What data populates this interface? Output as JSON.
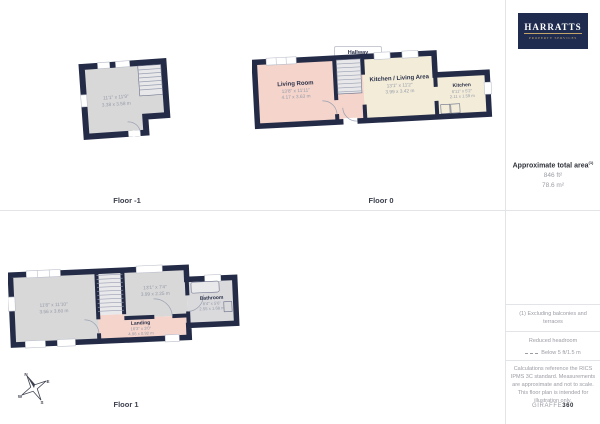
{
  "branding": {
    "logo_line1": "HARRATTS",
    "logo_line2": "PROPERTY SERVICES"
  },
  "sidebar": {
    "area_title": "Approximate total area",
    "area_superscript": "(1)",
    "area_ft": "846 ft²",
    "area_m": "78.6 m²",
    "note1": "(1) Excluding balconies and terraces",
    "headroom_title": "Reduced headroom",
    "headroom_value": "Below 5 ft/1.5 m",
    "disclaimer": "Calculations reference the RICS IPMS 3C standard. Measurements are approximate and not to scale. This floor plan is intended for illustration only.",
    "brand_gray": "GIRAFFE",
    "brand_bold": "360"
  },
  "floor_minus1": {
    "label": "Floor -1",
    "room": {
      "dims_ft": "11'1\" x 11'9\"",
      "dims_m": "3.38 x 3.58 m"
    }
  },
  "floor0": {
    "label": "Floor 0",
    "hallway_tag": "Hallway",
    "living_room": {
      "name": "Living Room",
      "dims_ft": "13'8\" x 11'11\"",
      "dims_m": "4.17 x 3.63 m"
    },
    "kitchen_living": {
      "name": "Kitchen / Living Area",
      "dims_ft": "13'1\" x 11'2\"",
      "dims_m": "3.99 x 3.42 m"
    },
    "kitchen": {
      "name": "Kitchen",
      "dims_ft": "6'11\" x 5'2\"",
      "dims_m": "2.11 x 1.59 m"
    }
  },
  "floor1": {
    "label": "Floor 1",
    "bedroom_left": {
      "dims_ft": "11'8\" x 11'10\"",
      "dims_m": "3.56 x 3.60 m"
    },
    "bedroom_right": {
      "dims_ft": "13'1\" x 7'4\"",
      "dims_m": "3.99 x 2.25 m"
    },
    "landing": {
      "name": "Landing",
      "dims_ft": "16'3\" x 3'0\"",
      "dims_m": "4.96 x 0.92 m"
    },
    "bathroom": {
      "name": "Bathroom",
      "dims_ft": "8'4\" x 5'6\"",
      "dims_m": "2.55 x 1.68 m"
    }
  },
  "compass": {
    "n": "N",
    "e": "E",
    "s": "S",
    "w": "W"
  },
  "colors": {
    "wall": "#242b46",
    "room_gray": "#d8d8d8",
    "room_pink": "#f4d4cb",
    "room_cream": "#f2ecd9",
    "logo_bg": "#1f2c50",
    "logo_gold": "#c3a469",
    "divider": "#e3e4e8",
    "dim_text": "#959aa8"
  }
}
